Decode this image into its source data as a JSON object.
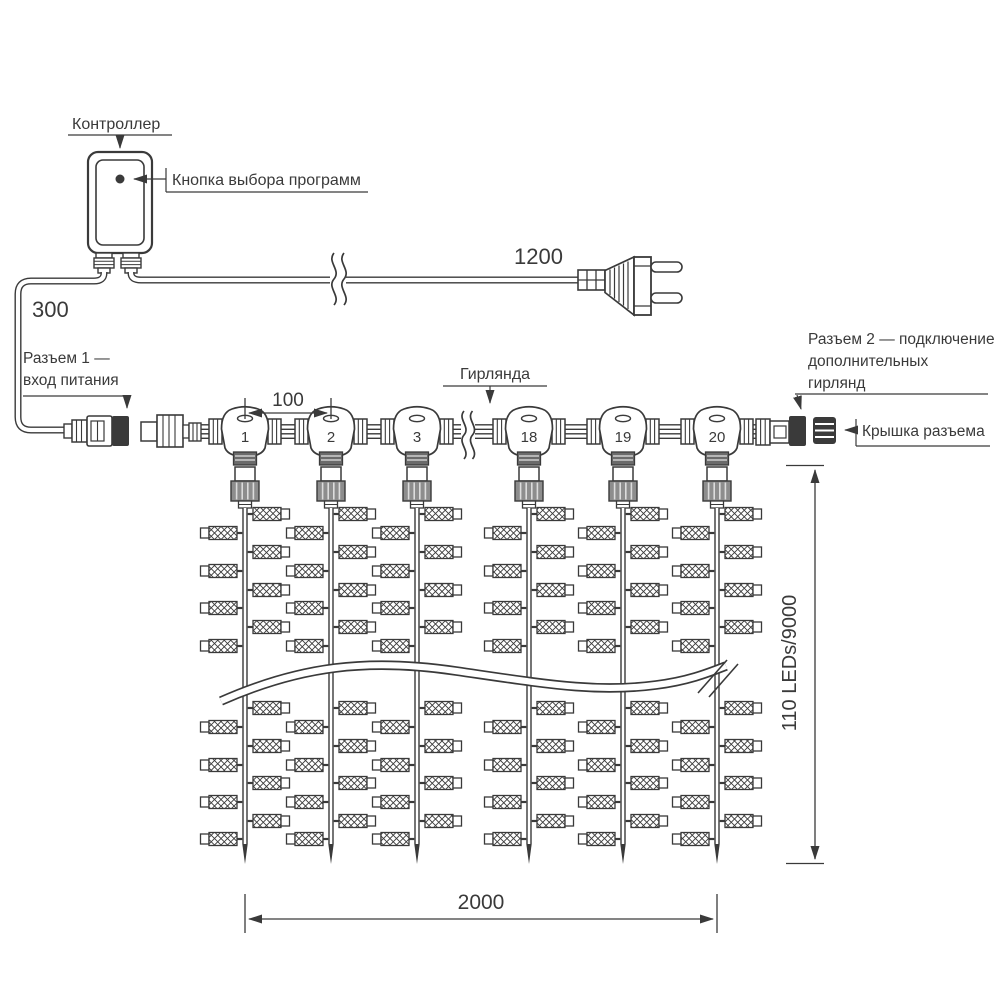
{
  "labels": {
    "controller": "Контроллер",
    "program_button": "Кнопка выбора программ",
    "connector1_line1": "Разъем 1 —",
    "connector1_line2": "вход питания",
    "garland": "Гирлянда",
    "connector2_line1": "Разъем 2 — подключение",
    "connector2_line2": "дополнительных",
    "connector2_line3": "гирлянд",
    "connector_cap": "Крышка разъема"
  },
  "dimensions": {
    "controller_cable_length": "300",
    "power_cable_length": "1200",
    "drop_spacing": "100",
    "curtain_width": "2000",
    "curtain_height": "110 LEDs/9000"
  },
  "t_connector_numbers": [
    "1",
    "2",
    "3",
    "18",
    "19",
    "20"
  ],
  "colors": {
    "line": "#3a3a3a",
    "background": "#ffffff"
  }
}
